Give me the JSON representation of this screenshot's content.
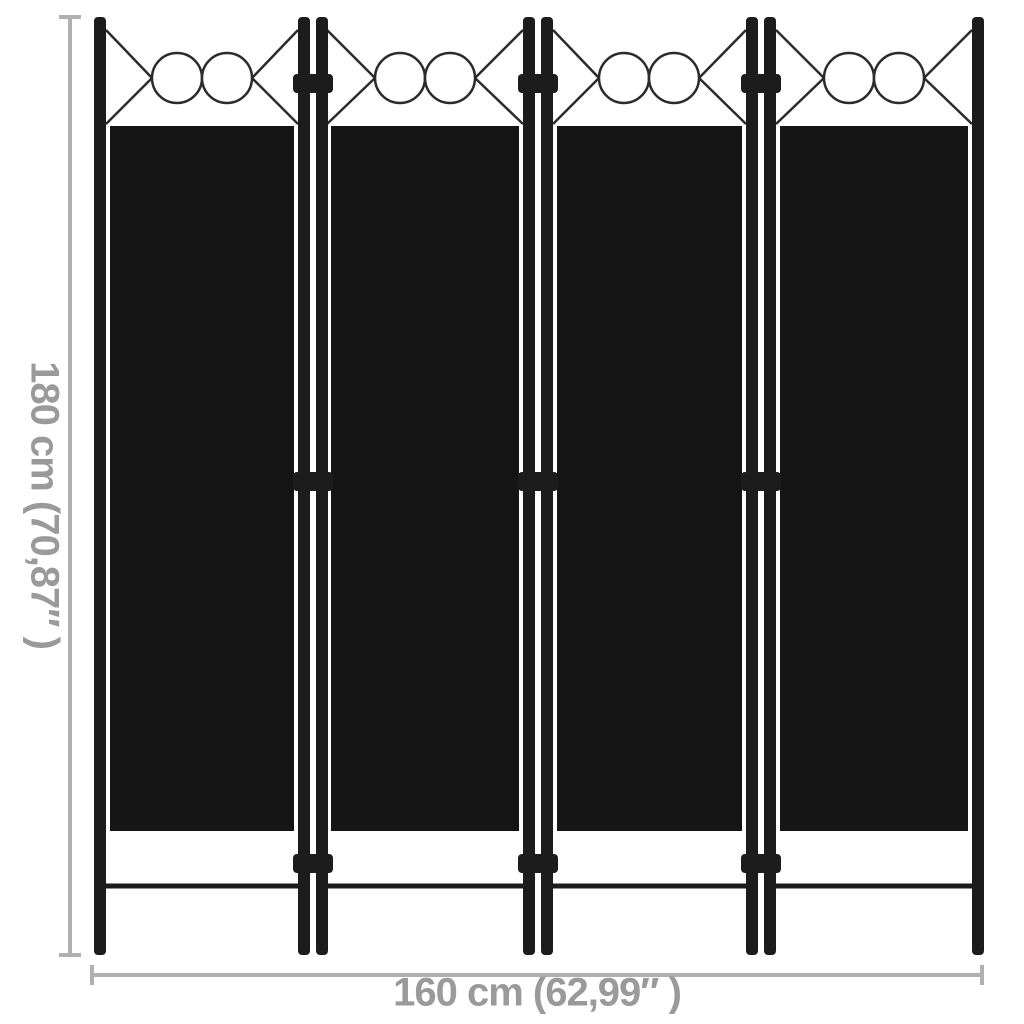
{
  "scene": {
    "description": "Product dimension diagram of a 4-panel black folding room divider screen",
    "panel_count": "4"
  },
  "dimensions": {
    "height_label": "180 cm (70,87″ )",
    "width_label": "160 cm (62,99″ )"
  },
  "colors": {
    "background": "#ffffff",
    "fabric_panel": "#151515",
    "frame_pole": "#1c1c1c",
    "decor_line_art": "#2b2b2b",
    "dimension_line": "#b0b0b0",
    "dimension_text": "#9a9a9a"
  }
}
